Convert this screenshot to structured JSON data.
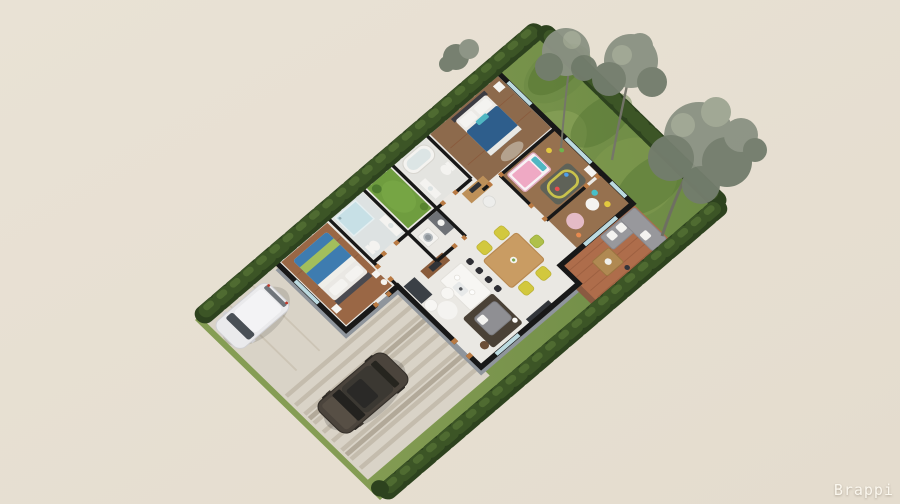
{
  "watermark": {
    "text": "Brappi",
    "color": "#FBF7EE"
  },
  "scene": {
    "kind": "isometric 3D floor plan rendering of a single-storey house lot",
    "background_color": "#E7E0D3",
    "palette": {
      "lawn": "#7C9450",
      "hedge": "#2D421E",
      "tree_foliage": "#8B9283",
      "concrete_driveway": "#D9D3C7",
      "paver_stripe": "#C4BCAD",
      "wall_top": "#181818",
      "wall_face": "#8F959C",
      "floor_tile": "#EAE8E3",
      "floor_wood": "#9A6745",
      "terrace_wood": "#AE6D4B",
      "window_glass": "#BCDAE0",
      "door_jamb": "#B97A43",
      "master_bed_blue": "#3E7CB0",
      "back_bed_navy": "#2E5E8C",
      "throw_green": "#A2BE5C",
      "kids_pink": "#EFA9C4",
      "dining_chair_yellow": "#D2C83E",
      "sofa_gray": "#98989C",
      "rug_dark": "#4A4136",
      "van_white": "#EAEAEC",
      "suv_dark": "#4B443C",
      "courtyard_grass": "#6F9D3F"
    },
    "rooms": [
      "master-bedroom",
      "bathroom",
      "inner-courtyard",
      "second-bathroom",
      "laundry",
      "back-bedroom",
      "kids-bedroom",
      "play-area",
      "kitchen",
      "dining-area",
      "entry-living",
      "terrace"
    ],
    "outdoors": [
      "driveway",
      "parking",
      "back-lawn",
      "perimeter-hedges",
      "trees"
    ],
    "vehicles": [
      "white-minivan",
      "dark-suv"
    ]
  }
}
